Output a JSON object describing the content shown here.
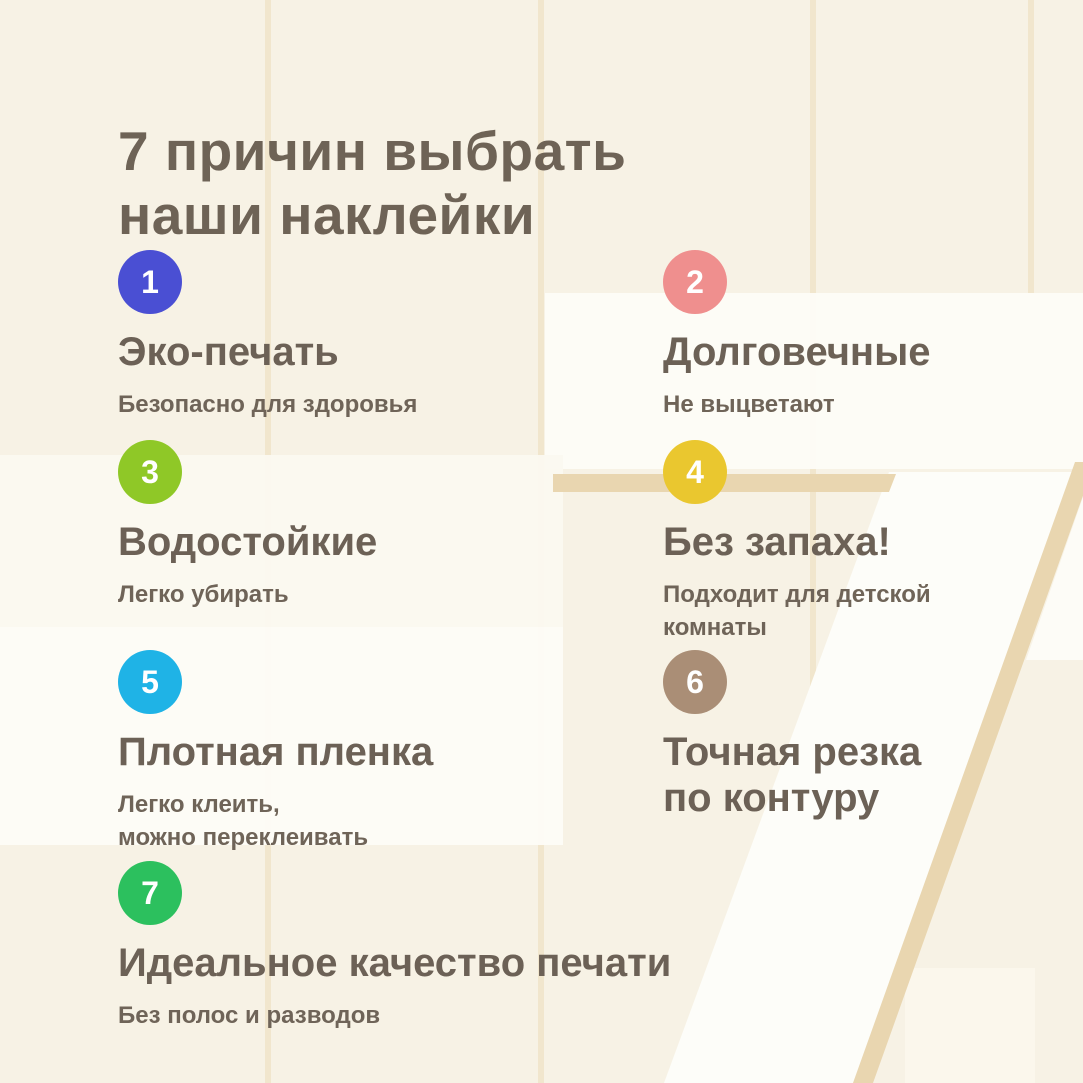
{
  "page": {
    "title_line1": "7 причин выбрать",
    "title_line2": "наши наклейки"
  },
  "items": [
    {
      "number": "1",
      "color": "#4a4fd3",
      "title": "Эко-печать",
      "subtitle": "Безопасно для здоровья"
    },
    {
      "number": "2",
      "color": "#ef8f8e",
      "title": "Долговечные",
      "subtitle": "Не выцветают"
    },
    {
      "number": "3",
      "color": "#8fc827",
      "title": "Водостойкие",
      "subtitle": "Легко убирать"
    },
    {
      "number": "4",
      "color": "#eac72f",
      "title": "Без запаха!",
      "subtitle": "Подходит для детской комнаты"
    },
    {
      "number": "5",
      "color": "#1fb3e6",
      "title": "Плотная пленка",
      "subtitle": "Легко клеить,\nможно переклеивать"
    },
    {
      "number": "6",
      "color": "#aa8e76",
      "title": "Точная резка по контуру",
      "subtitle": ""
    },
    {
      "number": "7",
      "color": "#2cc05e",
      "title": "Идеальное качество печати",
      "subtitle": "Без полос и разводов"
    }
  ],
  "background": {
    "base_color": "#f7f2e5",
    "card_color": "#fdfcf7",
    "watermark_digit": "7",
    "watermark_stroke_color": "#e9d6b0"
  }
}
